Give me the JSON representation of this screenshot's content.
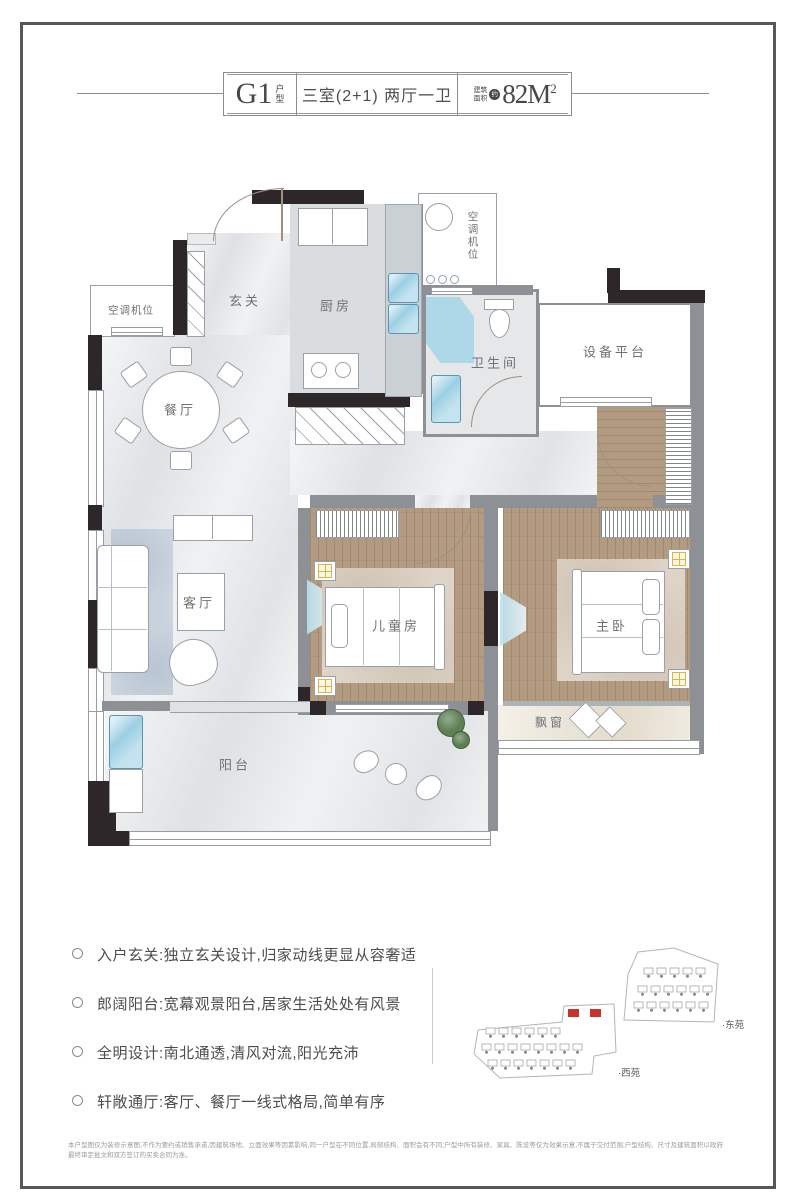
{
  "header": {
    "unit_code": "G1",
    "unit_type": "户型",
    "layout_desc": "三室(2+1) 两厅一卫",
    "area_label": "建筑面积",
    "area_approx": "约",
    "area_value": "82M",
    "area_sup": "2"
  },
  "plan": {
    "rooms": {
      "ac_left": "空调机位",
      "entry": "玄关",
      "kitchen": "厨房",
      "ac_top": "空调机位",
      "bath": "卫生间",
      "equipment": "设备平台",
      "dining": "餐厅",
      "living": "客厅",
      "kids": "儿童房",
      "master": "主卧",
      "bay": "飘窗",
      "balcony": "阳台"
    }
  },
  "features": {
    "items": [
      "入户玄关:独立玄关设计,归家动线更显从容奢适",
      "郎阔阳台:宽幕观景阳台,居家生活处处有风景",
      "全明设计:南北通透,清风对流,阳光充沛",
      "轩敞通厅:客厅、餐厅一线式格局,简单有序"
    ]
  },
  "siteplan": {
    "east": "·东苑",
    "west": "·西苑",
    "highlight_color": "#c8342c"
  },
  "colors": {
    "wall_dark": "#2e272a",
    "wall_gray": "#8d9196",
    "wood_floor": "#b39b81",
    "water_blue": "#9ccfe4",
    "lamp_yellow": "#d9b54a"
  },
  "disclaimer": "本户型图仅为装修示意图,不作为要约或销售承诺,因建筑场地、立面效果等因素影响,同一户型在不同位置,局部结构、面积会有不同;户型中所有装修、家具、陈设等仅为效果示意,不属于交付范围;户型结构、尺寸及建筑面积以政府最终审定批文和双方签订的买卖合同为准。"
}
